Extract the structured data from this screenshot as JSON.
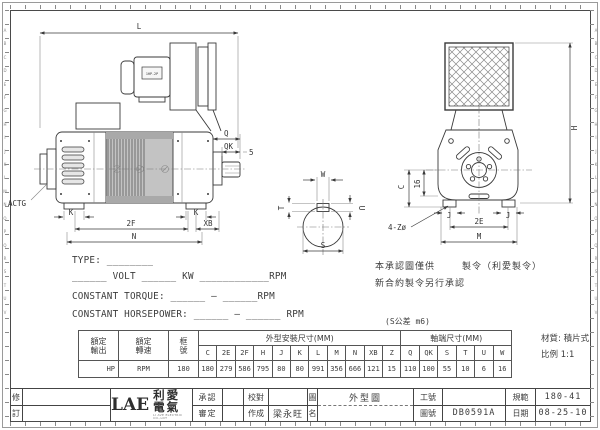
{
  "sheet": {
    "edge_letters": "A\nB\nC\nD\nE\nF\nG\nH\nI\nJ\nK\nL\nM\nN\nO\nP\nQ\nR\nS\nT\nU\nV",
    "line_color": "#3a3a3a",
    "bg_color": "#ffffff"
  },
  "left_view": {
    "labels": {
      "L": "L",
      "Q": "Q",
      "QK": "QK",
      "gap5": "5",
      "k_left": "K",
      "k_right": "K",
      "f2": "2F",
      "xb": "XB",
      "n": "N",
      "actg": "ACTG",
      "blower_plate": "1HP-2P"
    }
  },
  "right_view": {
    "labels": {
      "h": "H",
      "c": "C",
      "s16": "16",
      "holes": "4-Zø",
      "e2": "2E",
      "m": "M",
      "j_left": "J",
      "j_right": "J"
    }
  },
  "shaft_view": {
    "labels": {
      "w": "W",
      "u": "U",
      "t": "T",
      "s": "S"
    }
  },
  "spec_lines": {
    "type": "TYPE: ________",
    "power": "______ VOLT ______ KW ____________RPM",
    "torque": "CONSTANT TORQUE: ______ — ______RPM",
    "horsepower": "CONSTANT HORSEPOWER: ______ — ______ RPM"
  },
  "notes": {
    "line1_a": "本承認圖僅供",
    "line1_b": "製令（利愛製令）",
    "line2": "新合約製令另行承認"
  },
  "table": {
    "tolerance_note": "(S公差 m6)",
    "material_note": "材質: 積片式",
    "scale_note": "比例 1:1",
    "h_output_l1": "額定",
    "h_output_l2": "輸出",
    "h_speed_l1": "額定",
    "h_speed_l2": "轉速",
    "h_frame_l1": "框",
    "h_frame_l2": "號",
    "group1_label": "外型安裝尺寸(MM)",
    "group2_label": "軸端尺寸(MM)",
    "dim_cols": [
      "C",
      "2E",
      "2F",
      "H",
      "J",
      "K",
      "L",
      "M",
      "N",
      "XB",
      "Z"
    ],
    "shaft_cols": [
      "Q",
      "QK",
      "S",
      "T",
      "U",
      "W"
    ],
    "row": {
      "output": "HP",
      "speed": "RPM",
      "frame": "180",
      "dims": [
        "180",
        "279",
        "586",
        "795",
        "80",
        "80",
        "991",
        "356",
        "666",
        "121",
        "15"
      ],
      "shaft": [
        "110",
        "100",
        "55",
        "10",
        "6",
        "16"
      ]
    }
  },
  "title_block": {
    "rev_label_l1": "修",
    "rev_label_l2": "訂",
    "logo_text": "LAE",
    "logo_cn": "利愛電氣",
    "logo_sub": "LI AVE ELECTRIC CO.,LDT",
    "approve_label": "承認",
    "review_label": "審定",
    "check_label": "校對",
    "draft_label": "作成",
    "draft_value": "梁永旺",
    "name_label_l1": "圖",
    "name_label_l2": "名",
    "drawing_name": "外型圖",
    "work_no_label": "工號",
    "work_no_value": "",
    "drawing_no_label": "圖號",
    "drawing_no_value": "DB0591A",
    "spec_label": "規範",
    "spec_value": "180-41",
    "date_label": "日期",
    "date_value": "08-25-10"
  }
}
